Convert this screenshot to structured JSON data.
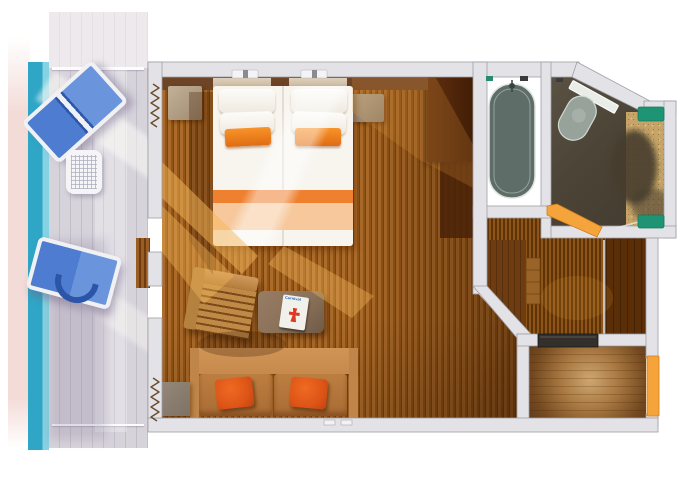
{
  "meta": {
    "type": "floor-plan-render",
    "description": "Top-down 3D rendering of a cruise-ship balcony stateroom floor plan on a white background"
  },
  "magazine": {
    "title": "Carnival"
  },
  "rooms": {
    "balcony": {
      "name": "balcony",
      "elements": [
        "lounge-chair",
        "lounge-chair",
        "patio-table",
        "railing",
        "ocean-stripe"
      ]
    },
    "stateroom": {
      "name": "stateroom",
      "elements": [
        "double-bed",
        "pillows",
        "accent-pillows",
        "nightstand-left",
        "nightstand-right",
        "headboard",
        "wardrobe",
        "armchair",
        "coffee-table",
        "magazine",
        "sofa",
        "sofa-pillows",
        "side-table",
        "curtains",
        "reading-lights"
      ]
    },
    "bathroom": {
      "name": "bathroom",
      "elements": [
        "bathtub",
        "shower-fixture",
        "sink",
        "sink-counter",
        "vanity-counter",
        "bath-mat-top",
        "bath-mat-bottom",
        "towel-bar"
      ]
    },
    "hallway": {
      "name": "entry-hallway",
      "elements": [
        "closet-left",
        "closet-right",
        "shelf-cabinet",
        "threshold-mat"
      ]
    },
    "doors": [
      "balcony-door",
      "bathroom-door",
      "entry-door"
    ]
  },
  "colors": {
    "wall_fill": "#e3e3e7",
    "wall_edge": "#9d9da5",
    "ocean": "#2fa6c6",
    "ocean_light": "#85d2e2",
    "deck_pink": "#f3dcd8",
    "deck_plank": "#d7d3db",
    "deck_line": "#c3bfca",
    "floor_light": "#ac6b2a",
    "floor_mid": "#8f5517",
    "floor_dark": "#7a4410",
    "wardrobe": "#54280b",
    "sun_gold": "#f5b85b",
    "bed_white": "#f8f5ef",
    "bed_orange": "#ef8030",
    "bed_peach": "#f6c89b",
    "pillow_orange": "#ee7d1d",
    "sofa": "#c68a4d",
    "sofa_cushion": "#bd7e41",
    "sofa_pillow": "#de5517",
    "chair_wood": "#bb854a",
    "table_taupe": "#8a7159",
    "bath_floor": "#7d8b84",
    "tub": "#5f6d69",
    "bath_dark": "#4c4436",
    "sink": "#97a29a",
    "vanity_sand": "#c6a468",
    "mat_green": "#1f9474",
    "door_orange": "#f5a43c",
    "hall_glow": "#cfa670",
    "hall_dark": "#5e3c1c",
    "closet_left": "#6e3c10",
    "closet_right": "#5a2f07",
    "magazine_red": "#dd3a22",
    "magazine_blue": "#2a6db5",
    "curtain": "#55320f",
    "threshold": "#33302b"
  }
}
